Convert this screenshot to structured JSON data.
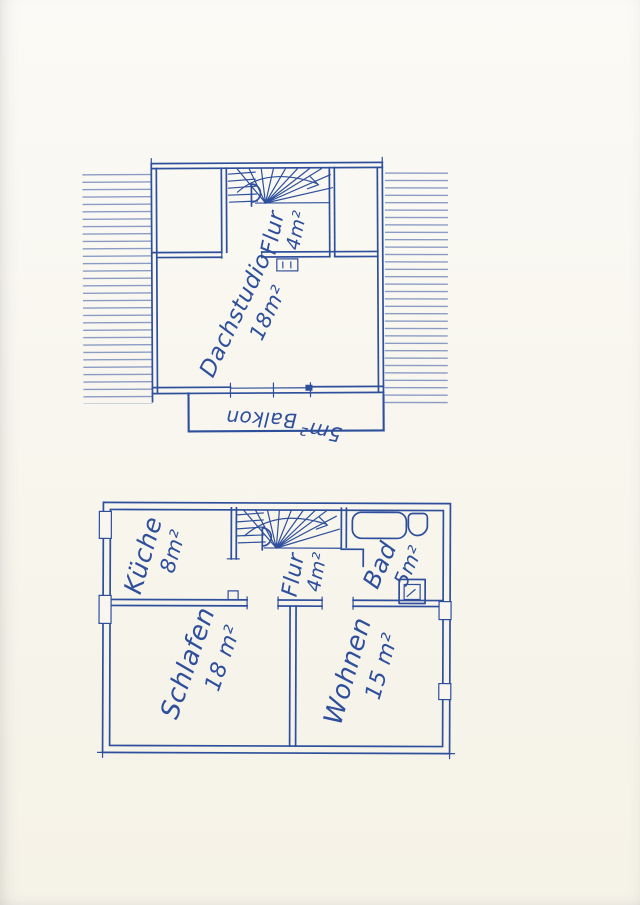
{
  "colors": {
    "ink": "#2e4f9c",
    "ink-light": "#7489bb",
    "paper": "#f8f6ee"
  },
  "upper_floor": {
    "flur": {
      "label": "Flur",
      "area": "4m²"
    },
    "dachstudio": {
      "label": "Dachstudio",
      "area": "18m²"
    },
    "balkon": {
      "label": "Balkon",
      "area": "5m²"
    }
  },
  "lower_floor": {
    "kueche": {
      "label": "Küche",
      "area": "8m²"
    },
    "flur": {
      "label": "Flur",
      "area": "4m²"
    },
    "bad": {
      "label": "Bad",
      "area": "5m²"
    },
    "schlafen": {
      "label": "Schlafen",
      "area": "18 m²"
    },
    "wohnen": {
      "label": "Wohnen",
      "area": "15 m²"
    }
  }
}
